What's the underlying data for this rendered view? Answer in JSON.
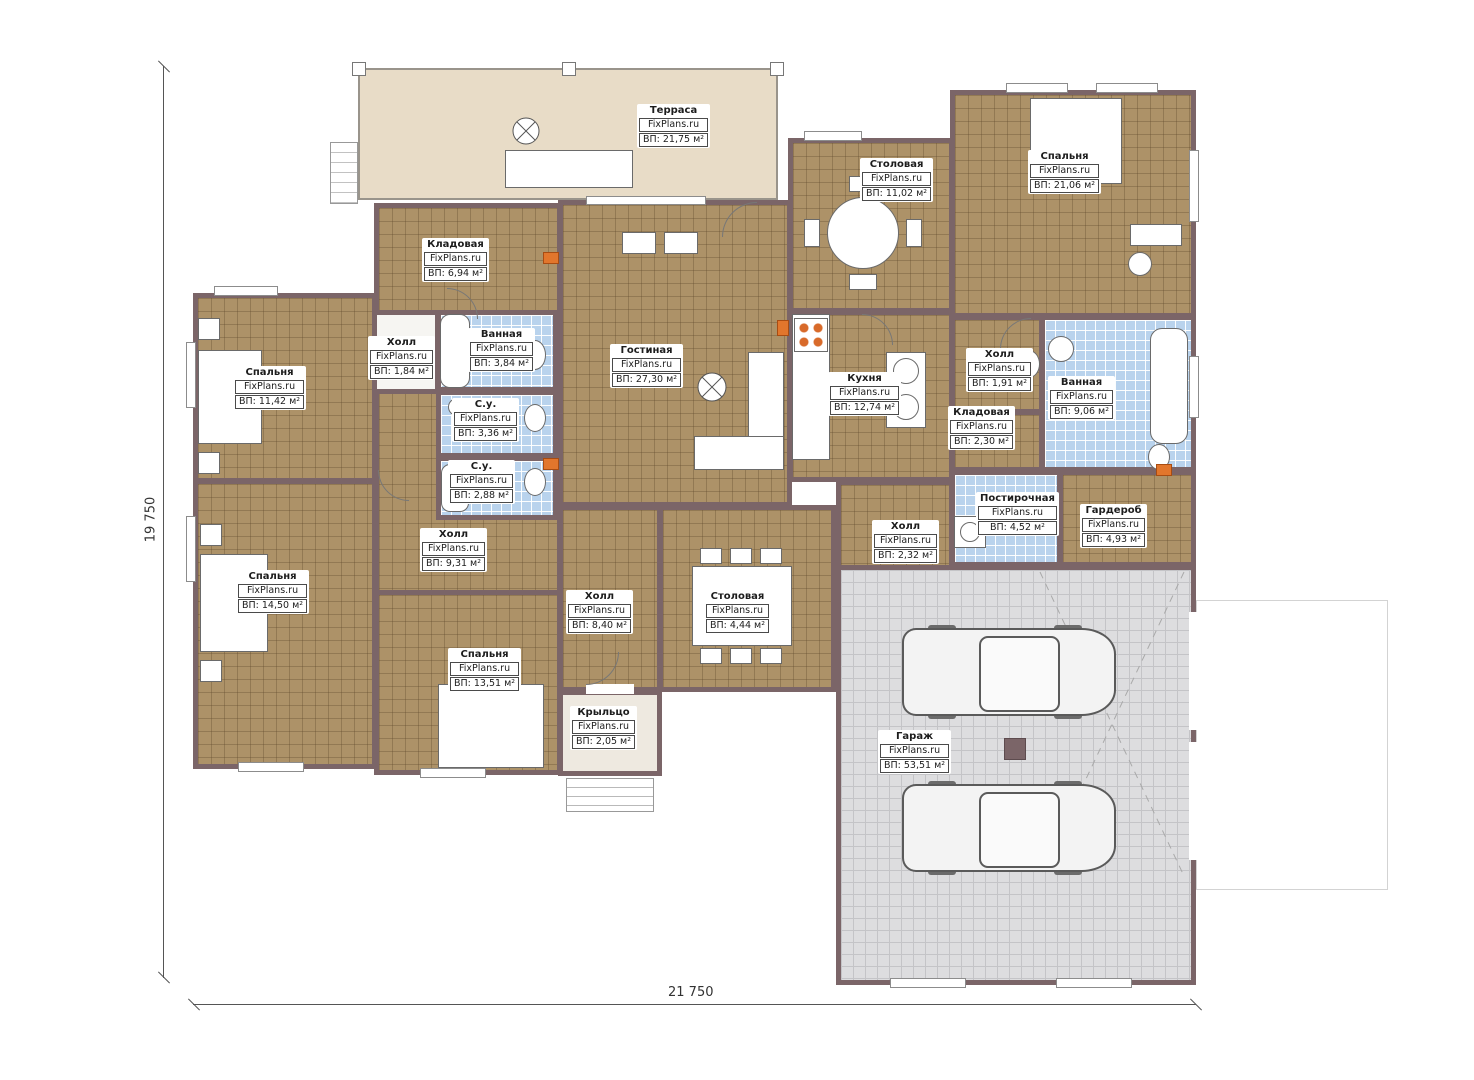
{
  "meta": {
    "brand": "FixPlans.ru"
  },
  "dimensions": {
    "height_label": "19 750",
    "width_label": "21 750"
  },
  "colors": {
    "wall": "#7b6568",
    "floor_tan": "#ad9268",
    "floor_blue": "#b9d3ed",
    "floor_gray": "#dddddf",
    "terrace": "#e8dcc7",
    "marker_orange": "#e2762c"
  },
  "rooms": [
    {
      "name": "Терраса",
      "area": "ВП: 21,75 м²"
    },
    {
      "name": "Спальня",
      "area": "ВП: 21,06 м²"
    },
    {
      "name": "Столовая",
      "area": "ВП: 11,02 м²"
    },
    {
      "name": "Кладовая",
      "area": "ВП: 6,94 м²"
    },
    {
      "name": "Холл",
      "area": "ВП: 1,84 м²"
    },
    {
      "name": "Ванная",
      "area": "ВП: 3,84 м²"
    },
    {
      "name": "С.у.",
      "area": "ВП: 3,36 м²"
    },
    {
      "name": "С.у.",
      "area": "ВП: 2,88 м²"
    },
    {
      "name": "Гостиная",
      "area": "ВП: 27,30 м²"
    },
    {
      "name": "Кухня",
      "area": "ВП: 12,74 м²"
    },
    {
      "name": "Холл",
      "area": "ВП: 1,91 м²"
    },
    {
      "name": "Ванная",
      "area": "ВП: 9,06 м²"
    },
    {
      "name": "Кладовая",
      "area": "ВП: 2,30 м²"
    },
    {
      "name": "Спальня",
      "area": "ВП: 11,42 м²"
    },
    {
      "name": "Спальня",
      "area": "ВП: 14,50 м²"
    },
    {
      "name": "Холл",
      "area": "ВП: 9,31 м²"
    },
    {
      "name": "Спальня",
      "area": "ВП: 13,51 м²"
    },
    {
      "name": "Холл",
      "area": "ВП: 8,40 м²"
    },
    {
      "name": "Столовая",
      "area": "ВП: 4,44 м²"
    },
    {
      "name": "Крыльцо",
      "area": "ВП: 2,05 м²"
    },
    {
      "name": "Постирочная",
      "area": "ВП: 4,52 м²"
    },
    {
      "name": "Гардероб",
      "area": "ВП: 4,93 м²"
    },
    {
      "name": "Холл",
      "area": "ВП: 2,32 м²"
    },
    {
      "name": "Гараж",
      "area": "ВП: 53,51 м²"
    }
  ]
}
